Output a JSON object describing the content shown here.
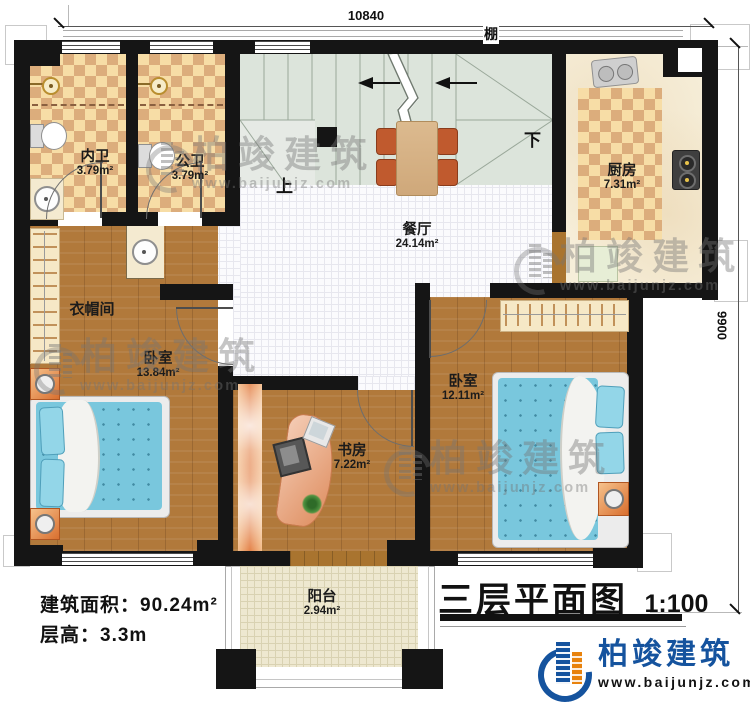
{
  "dims": {
    "top": "10840",
    "right": "9900"
  },
  "annotations": {
    "canopy": "棚",
    "stairs_up": "上",
    "stairs_down": "下"
  },
  "rooms": {
    "inner_bath": {
      "name": "内卫",
      "area": "3.79m²"
    },
    "public_bath": {
      "name": "公卫",
      "area": "3.79m²"
    },
    "kitchen": {
      "name": "厨房",
      "area": "7.31m²"
    },
    "dining": {
      "name": "餐厅",
      "area": "24.14m²"
    },
    "cloakroom": {
      "name": "衣帽间"
    },
    "bedroom_left": {
      "name": "卧室",
      "area": "13.84m²"
    },
    "bedroom_right": {
      "name": "卧室",
      "area": "12.11m²"
    },
    "study": {
      "name": "书房",
      "area": "7.22m²"
    },
    "balcony": {
      "name": "阳台",
      "area": "2.94m²"
    }
  },
  "info": {
    "area_line": "建筑面积：90.24m²",
    "height_line": "层高：3.3m"
  },
  "title": {
    "name": "三层平面图",
    "scale": "1:100"
  },
  "brand": {
    "name": "柏竣建筑",
    "url": "www.baijunjz.com"
  },
  "watermark": {
    "name": "柏竣建筑",
    "url": "www.baijunjz.com"
  },
  "colors": {
    "wall": "#151515",
    "brand_blue": "#15539e",
    "brand_orange": "#e8820c",
    "bed_blue": "#79c7dd"
  }
}
